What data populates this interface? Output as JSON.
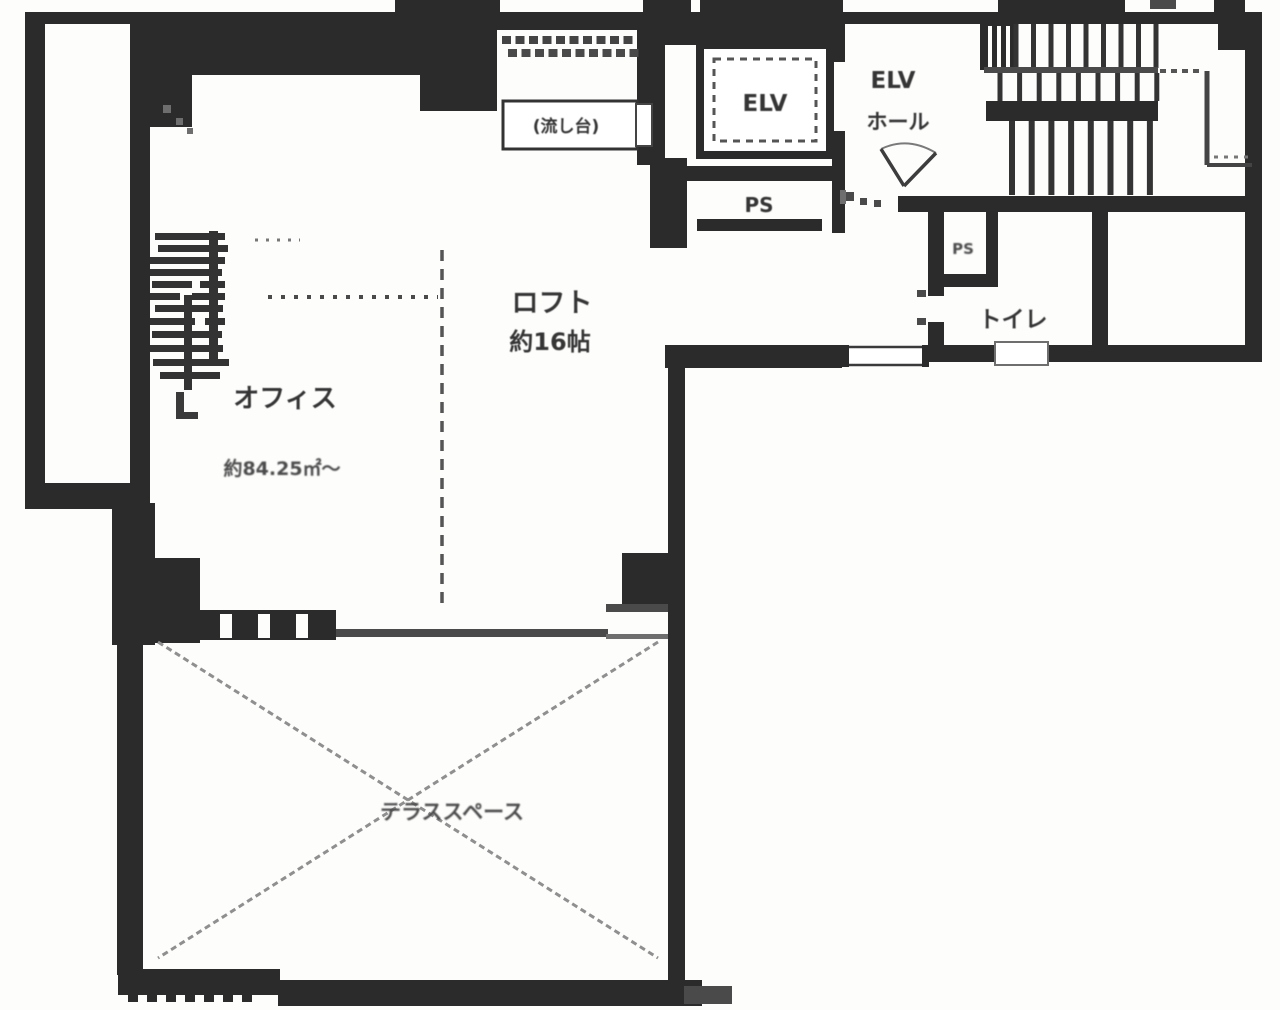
{
  "document": {
    "type": "floor-plan-scan",
    "description": "Scanned monochrome architectural floor plan of an office unit with loft, elevator hall, stairs, toilet and terrace"
  },
  "colors": {
    "wall": "#2b2b2b",
    "medium_line": "#4a4a4a",
    "light_line": "#8f8f8f",
    "text": "#353535",
    "background": "#fdfdfc"
  },
  "rooms": {
    "office": {
      "label": "オフィス",
      "area_note": "約84.25㎡～"
    },
    "loft": {
      "label": "ロフト",
      "size": "約16帖"
    },
    "terrace": {
      "label": "テラススペース"
    },
    "toilet": {
      "label": "トイレ"
    },
    "elevator_shaft": {
      "label": "ELV"
    },
    "elevator_hall": {
      "label_line1": "ELV",
      "label_line2": "ホール"
    },
    "pipe_space_main": {
      "label": "PS"
    },
    "pipe_space_small": {
      "label": "PS"
    },
    "kitchen_sink": {
      "label": "(流し台)"
    }
  }
}
